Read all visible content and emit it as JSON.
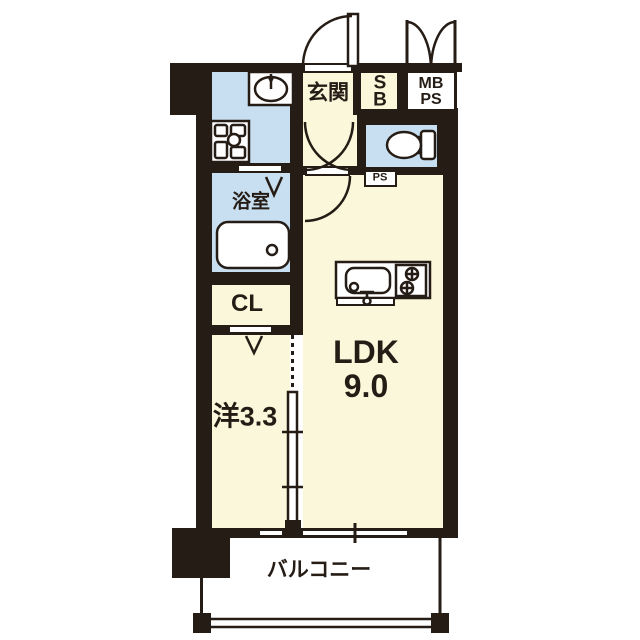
{
  "title": "1LDK apartment floor plan",
  "colors": {
    "wall": "#261c16",
    "cream": "#fbf7da",
    "blue": "#c7dff0",
    "white": "#ffffff"
  },
  "rooms": {
    "genkan": {
      "label": "玄関"
    },
    "shoe_box": {
      "line1": "S",
      "line2": "B"
    },
    "meter_pipe_space": {
      "line1": "MB",
      "line2": "PS"
    },
    "bathroom": {
      "label": "浴室"
    },
    "pipe_space": {
      "label": "PS"
    },
    "closet": {
      "label": "CL"
    },
    "ldk": {
      "line1": "LDK",
      "line2": "9.0"
    },
    "western_room": {
      "label": "洋3.3"
    },
    "balcony": {
      "label": "バルコニー"
    }
  },
  "icons": [
    "entrance-door-swing-icon",
    "double-door-swing-icon",
    "washbasin-icon",
    "washing-machine-pan-icon",
    "bathtub-icon",
    "toilet-icon",
    "kitchen-sink-icon",
    "stove-burners-icon",
    "sliding-partition-icon",
    "balcony-railing-icon"
  ]
}
